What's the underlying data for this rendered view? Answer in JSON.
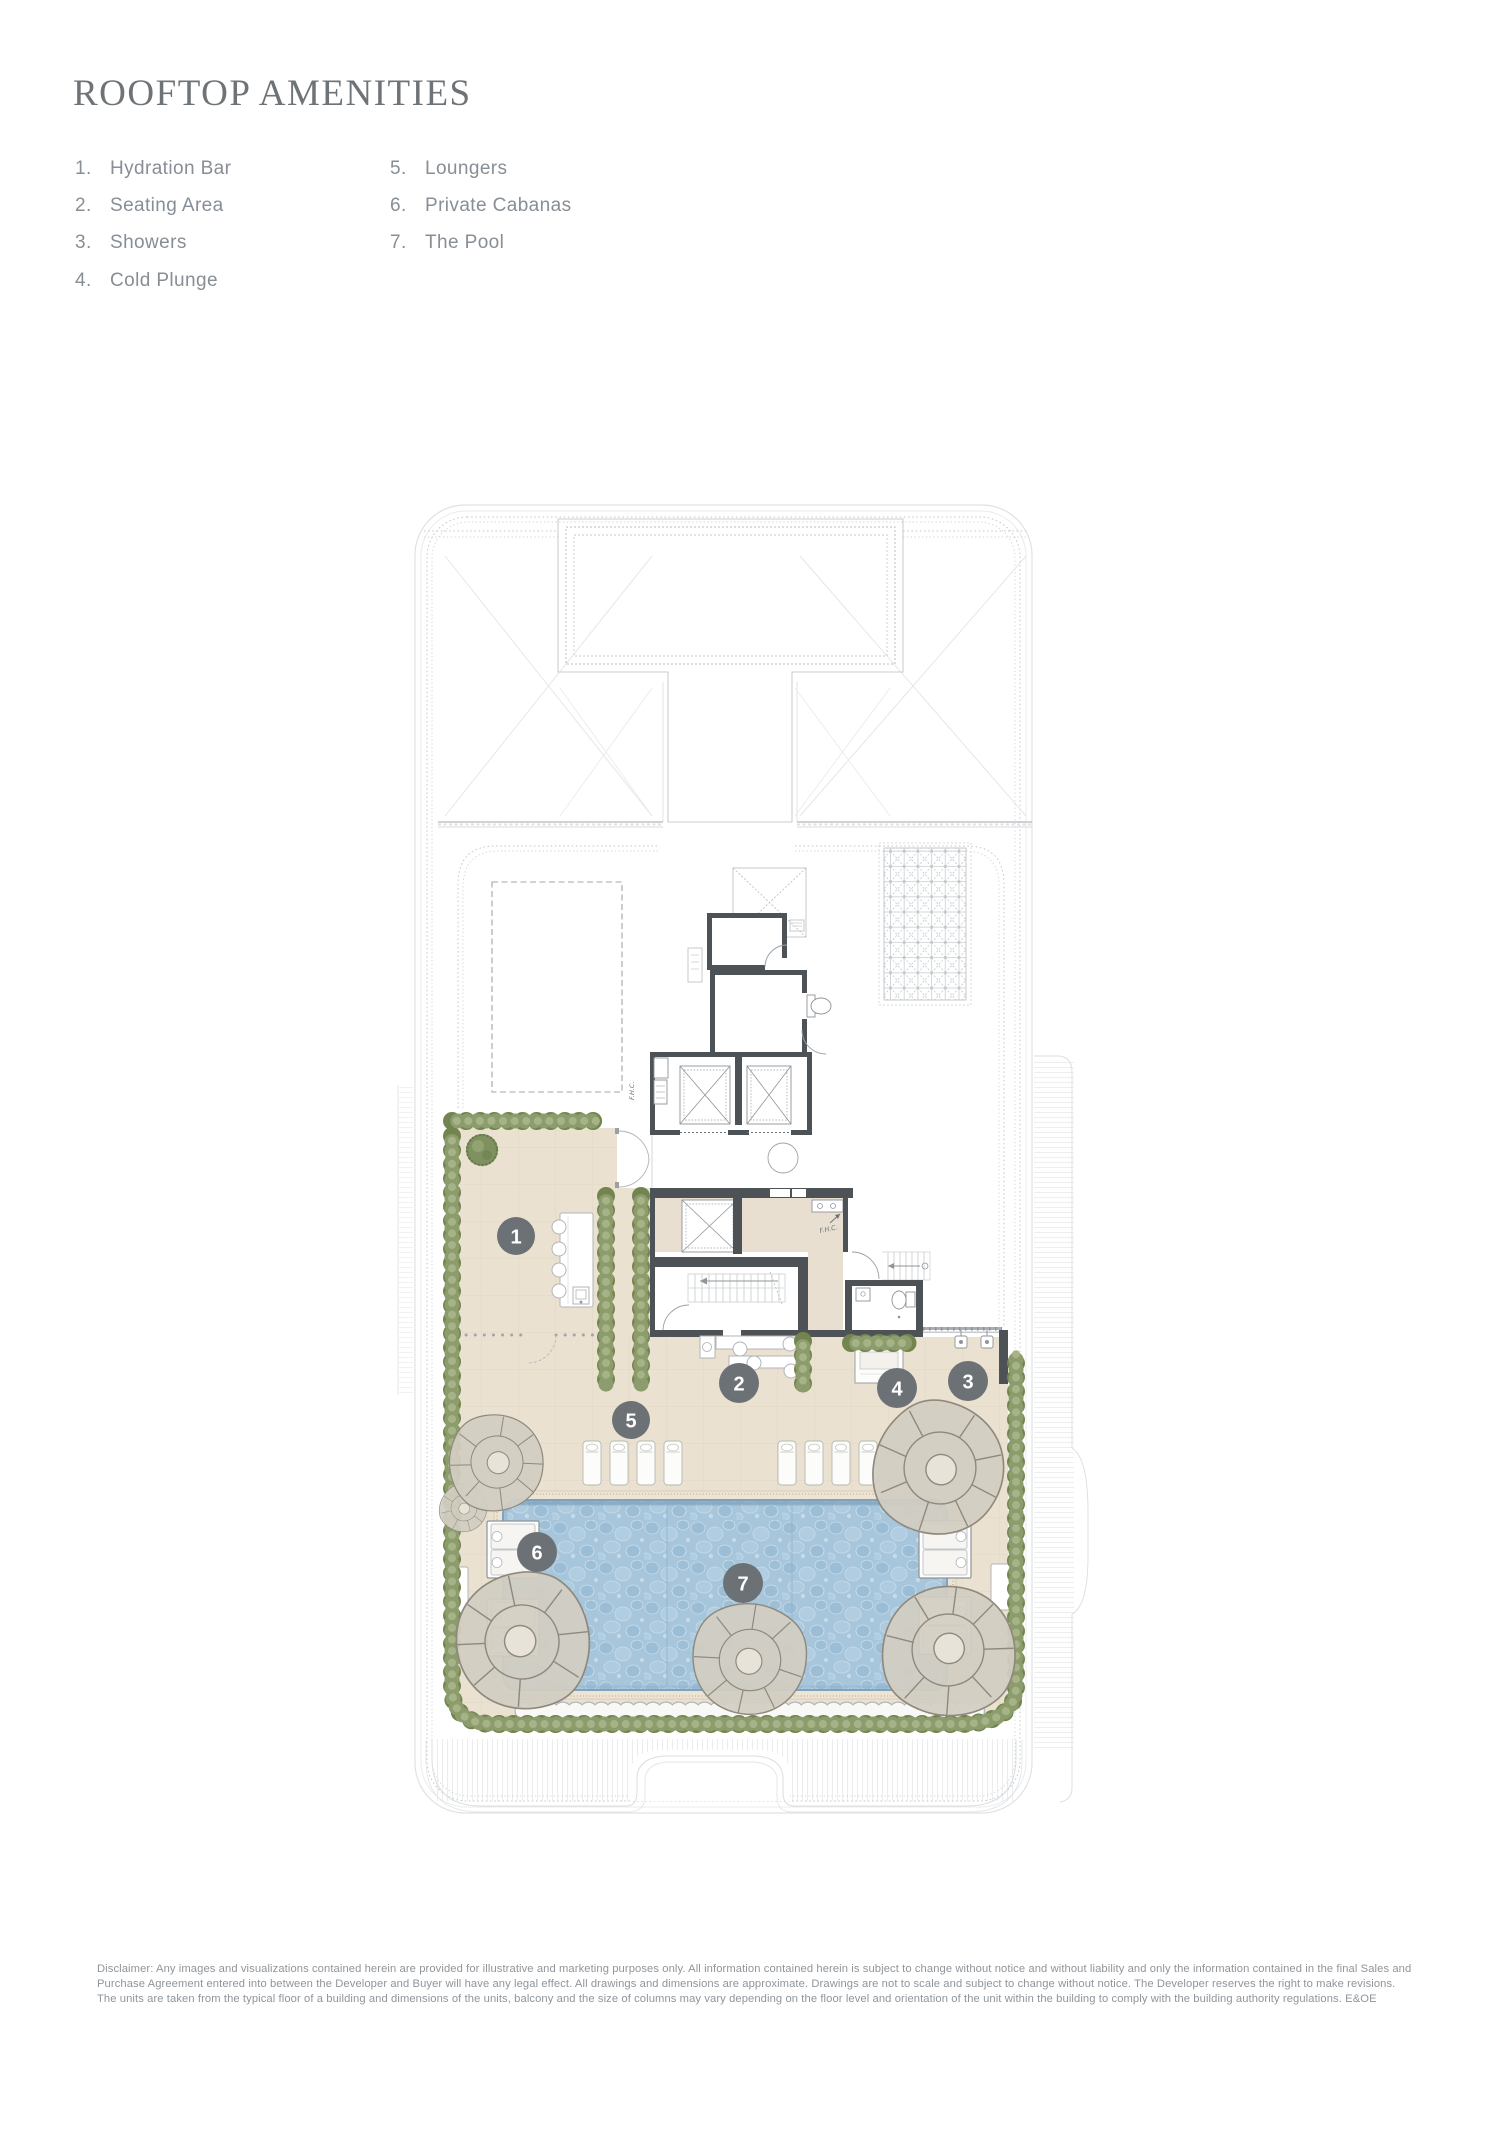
{
  "title": "ROOFTOP AMENITIES",
  "legend": {
    "items": [
      {
        "num": "1.",
        "label": "Hydration Bar"
      },
      {
        "num": "2.",
        "label": "Seating Area"
      },
      {
        "num": "3.",
        "label": "Showers"
      },
      {
        "num": "4.",
        "label": "Cold Plunge"
      },
      {
        "num": "5.",
        "label": "Loungers"
      },
      {
        "num": "6.",
        "label": "Private Cabanas"
      },
      {
        "num": "7.",
        "label": "The Pool"
      }
    ]
  },
  "plan": {
    "markers": [
      "1",
      "2",
      "3",
      "4",
      "5",
      "6",
      "7"
    ],
    "annotations": {
      "fhc": "F.H.C."
    },
    "colors": {
      "wall": "#4d5256",
      "terrace": "#e9dfd0",
      "hedge": "#8c9c6d",
      "pool": "#a7c6dc",
      "marker": "#6c7175",
      "title": "#6e7377",
      "legend_text": "#878e95"
    }
  },
  "disclaimer": {
    "text": "Disclaimer: Any images and visualizations contained herein are provided for illustrative and marketing purposes only. All information contained herein is subject to change without notice and without liability and only the information contained in the final Sales and Purchase Agreement entered into between the Developer and Buyer will have any legal effect. All drawings and dimensions are approximate. Drawings are not to scale and subject to change without notice. The Developer reserves the right to make revisions. The units are taken from the typical floor of a building and dimensions of the units, balcony and the size of columns may vary depending on the floor level and orientation of the unit within the building to comply with the building authority regulations. E&OE"
  }
}
